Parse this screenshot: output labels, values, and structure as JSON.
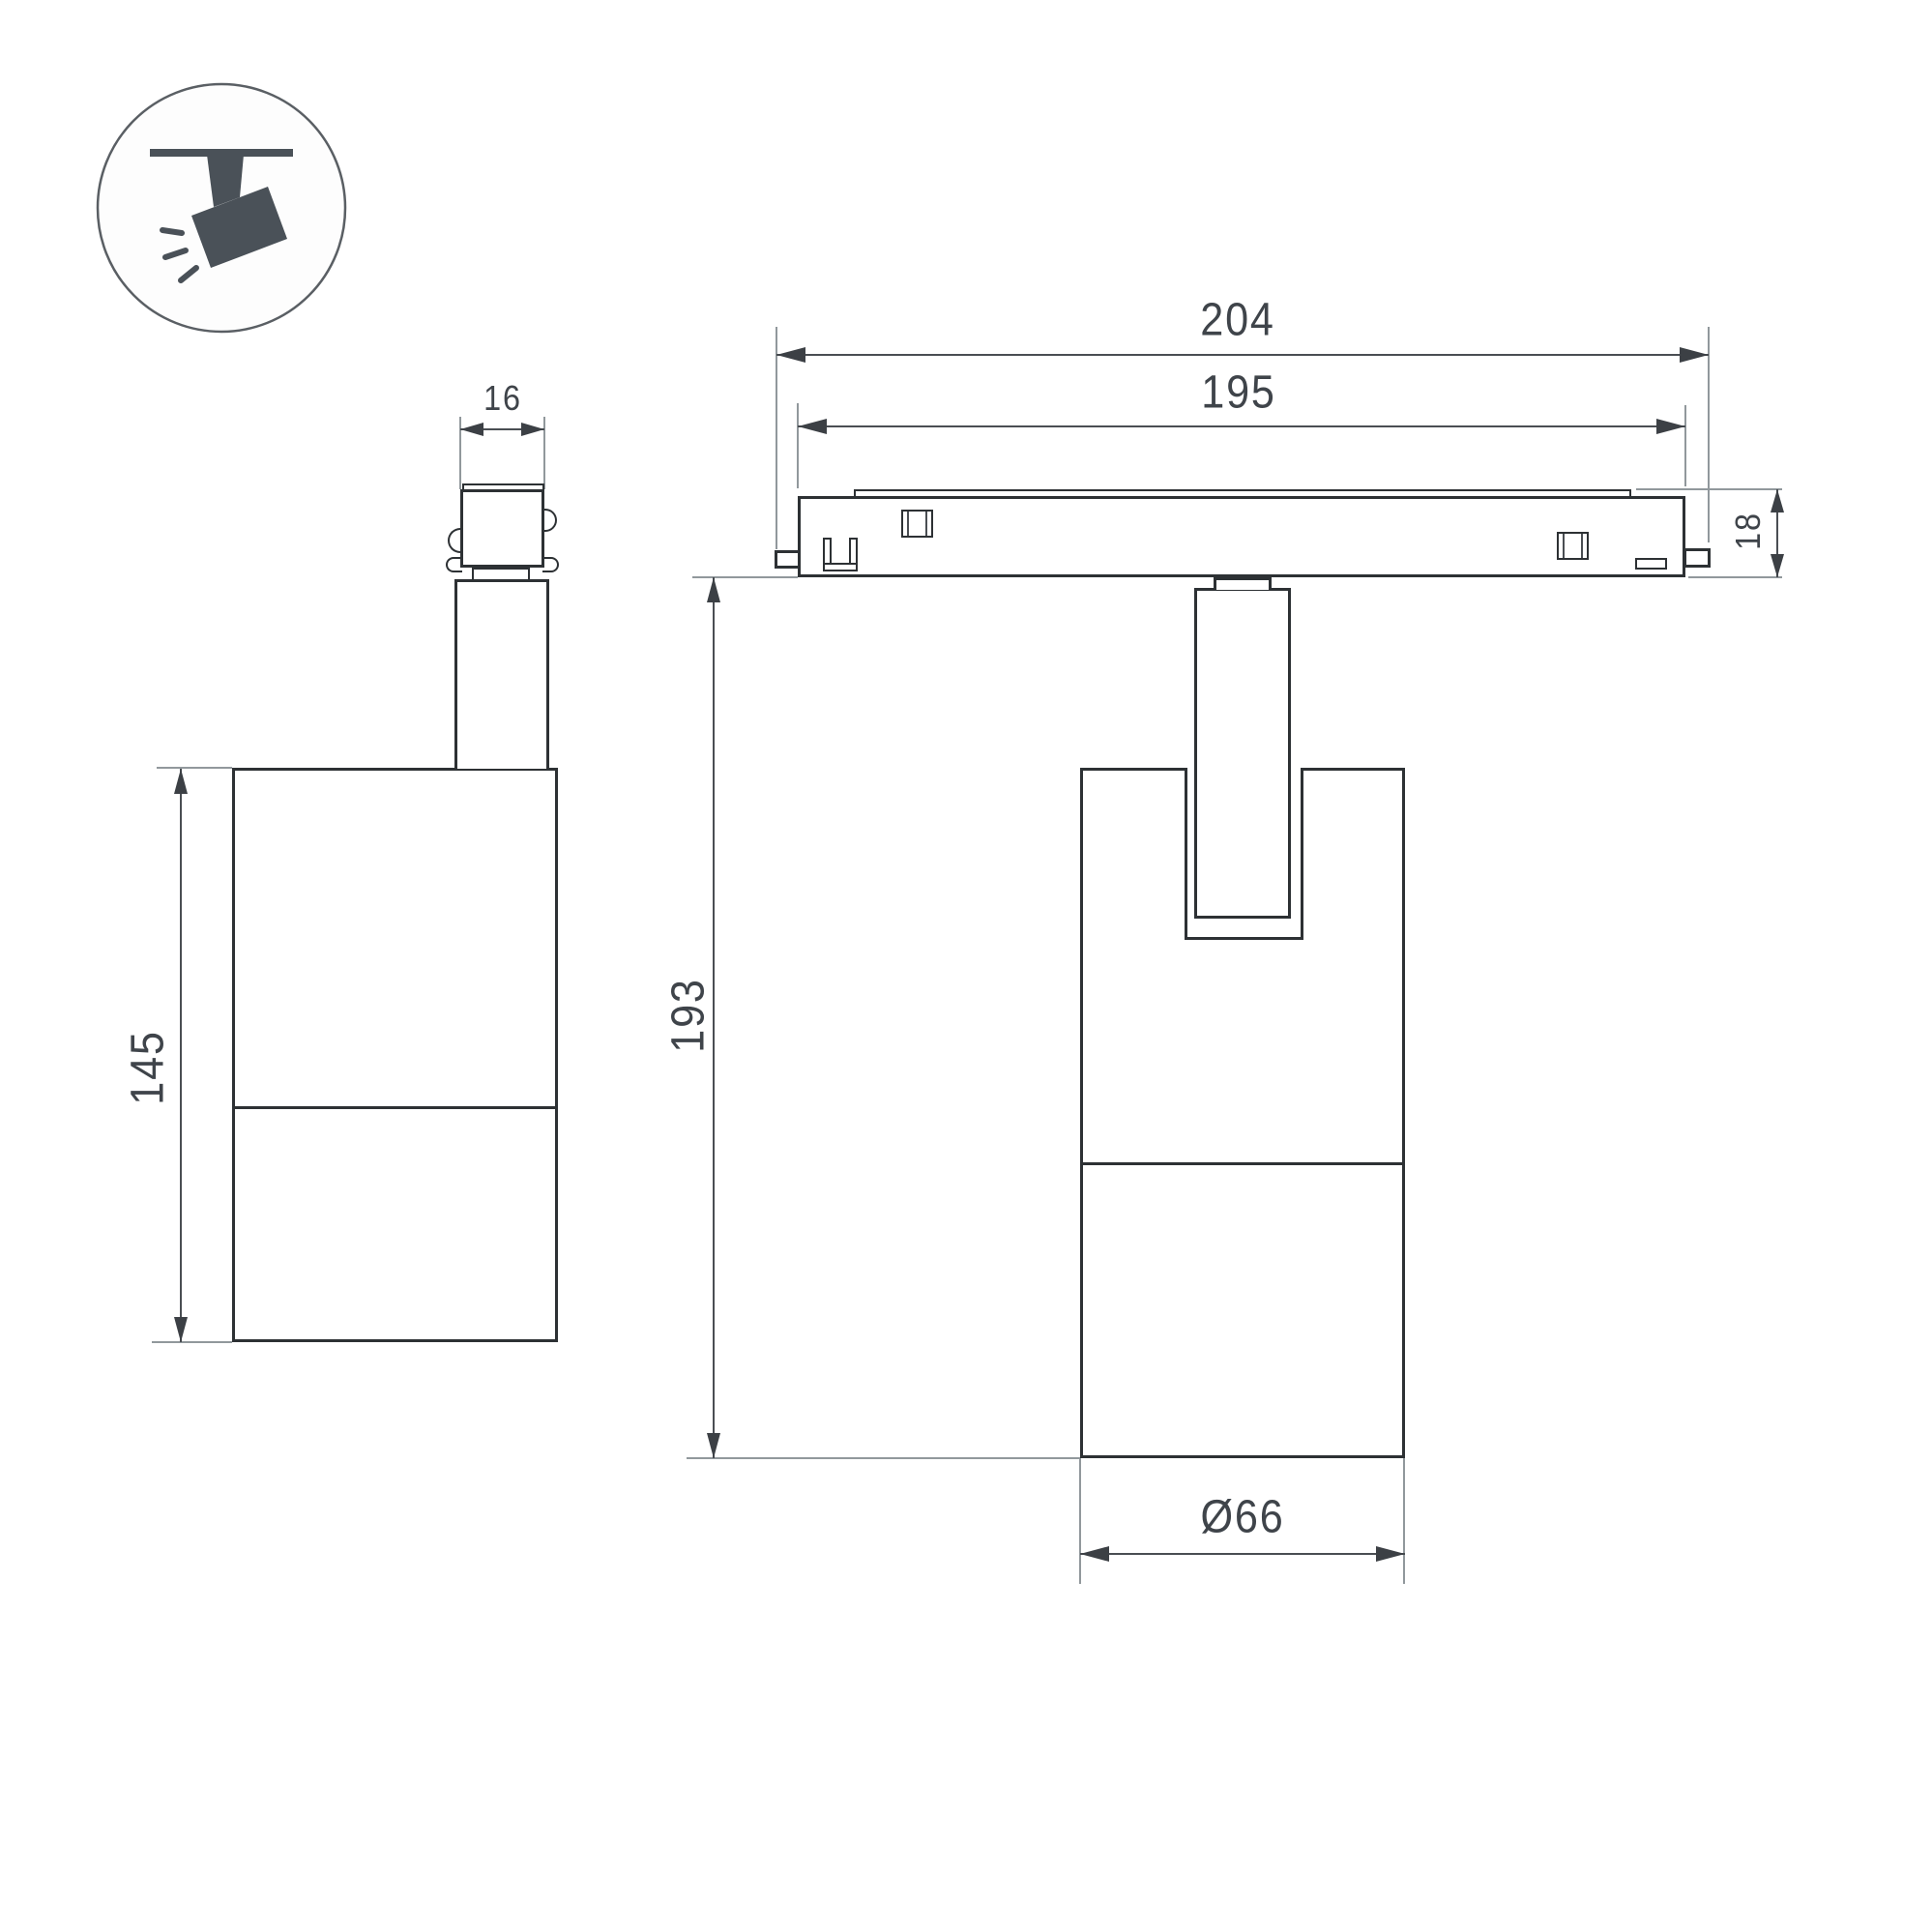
{
  "drawing": {
    "icon": "track-spotlight-icon",
    "colors": {
      "outline": "#2d3134",
      "dimension_line": "#4a4e53",
      "extension_line": "#91989c",
      "text": "#3f444a",
      "icon_fill": "#4a5158",
      "background": "#ffffff"
    },
    "dimensions": {
      "adapter_width": "16",
      "track_overall_length": "204",
      "track_body_length": "195",
      "track_height": "18",
      "lamp_body_height": "145",
      "overall_drop": "193",
      "body_diameter": "Ø66"
    }
  }
}
